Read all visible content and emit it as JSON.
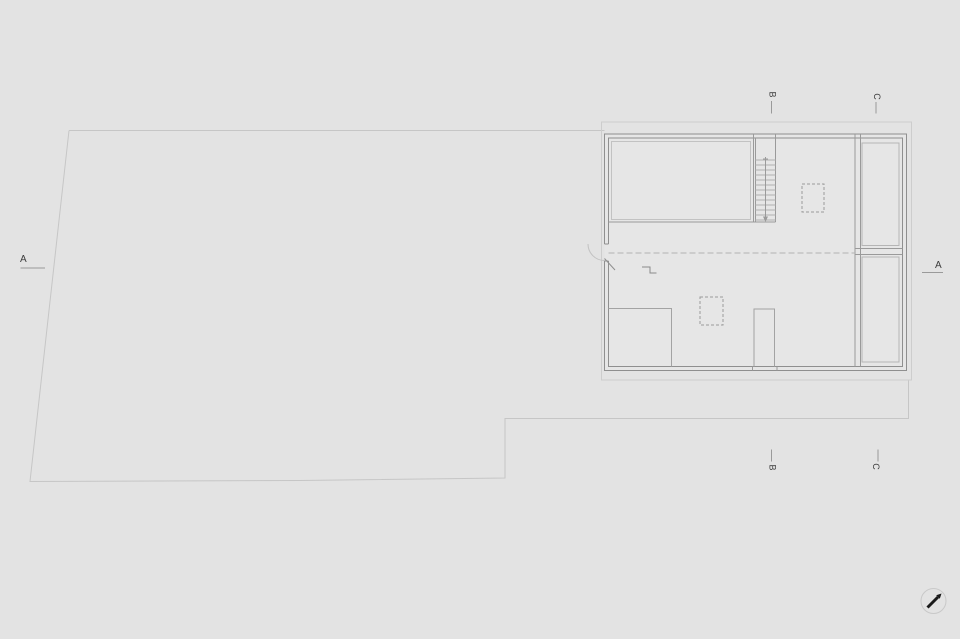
{
  "sheet": {
    "type": "architectural-floor-plan",
    "background": "#e3e3e3"
  },
  "colors": {
    "site_line": "#c6c6c6",
    "roof_outline": "#cdcdcd",
    "wall_line": "#8f8f8f",
    "partition_line": "#a3a3a3",
    "finish_line": "#c2c2c2",
    "tread_line": "#b0b0b0",
    "dashed_line": "#9a9a9a",
    "centerline": "#b3b3b3",
    "marker_line": "#9a9a9a",
    "marker_text": "#3c3c3c",
    "north_arrow": "#1a1a1a",
    "building_fill": "#e6e6e6"
  },
  "section_markers": {
    "a_left": {
      "label": "A"
    },
    "a_right": {
      "label": "A"
    },
    "b_top": {
      "label": "B"
    },
    "b_bottom": {
      "label": "B"
    },
    "c_top": {
      "label": "C"
    },
    "c_bottom": {
      "label": "C"
    }
  },
  "icons": {
    "north_arrow": "north-arrow"
  },
  "plan": {
    "elements": [
      "site-boundary",
      "roof-outline",
      "exterior-walls",
      "entry-door",
      "upper-left-room",
      "staircase",
      "stair-direction-line",
      "skylight-upper",
      "skylight-lower",
      "right-gallery-wall",
      "right-gallery-cells",
      "lower-left-partition",
      "under-stair-shaft",
      "level-step-symbol",
      "dashed-centerline"
    ]
  }
}
